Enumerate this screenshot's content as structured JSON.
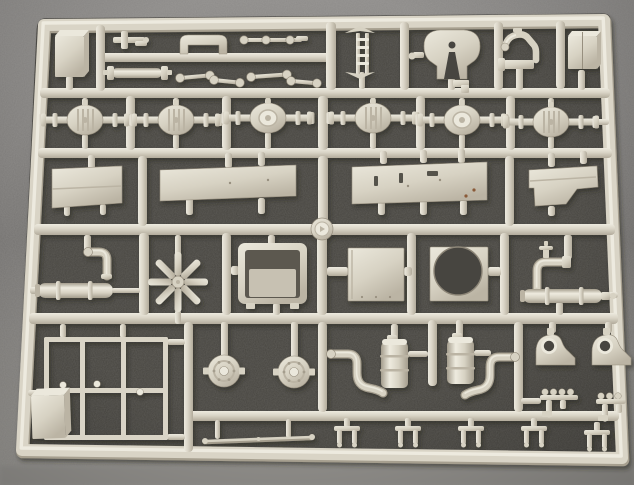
{
  "image": {
    "width": 634,
    "height": 485,
    "alt": "Photo of a light-beige plastic model kit sprue (runner frame) holding truck parts on a dark gray speckled surface"
  },
  "palette": {
    "bgTop": "#8d8b89",
    "bgMid": "#757371",
    "bgBottom": "#93918d",
    "window": "#46443f",
    "barHi": "#edeadf",
    "barMid": "#d9d4c6",
    "barLo": "#b2ab9b",
    "barShadow": "#a69f8f",
    "partHi": "#ebe8dc",
    "partMid": "#d7d2c3",
    "partLo": "#bbb4a4",
    "cylEdge": "#a49d8d",
    "cylLight": "#eeebdf",
    "line": "#978f7f",
    "dark": "#55524b",
    "rust": "#8a5a38"
  },
  "sprue": {
    "frame": {
      "path": "M 44 25 L 604 20 L 622 458 L 22 450 Z",
      "width": 13
    },
    "silhouette": "M 45 18.3 L 603 13.5 Q 610.5 13.4 610.8 21 L 628.3 451 Q 628.6 464.4 621 464.2 L 29 456.8 Q 15.6 456.6 16.6 445 L 36.6 29 Q 37.8 18.4 45 18.3 Z",
    "hbars": [
      [
        96,
        53,
        238,
        9
      ],
      [
        40,
        88,
        570,
        10
      ],
      [
        38,
        148,
        574,
        10
      ],
      [
        34,
        224,
        581,
        11
      ],
      [
        29,
        313,
        589,
        11
      ],
      [
        187,
        411,
        432,
        10
      ]
    ],
    "vbars": [
      [
        96,
        25,
        9,
        66
      ],
      [
        326,
        22,
        10,
        68
      ],
      [
        400,
        22,
        9,
        68
      ],
      [
        494,
        22,
        9,
        68
      ],
      [
        556,
        21,
        9,
        68
      ],
      [
        126,
        96,
        9,
        54
      ],
      [
        222,
        96,
        9,
        54
      ],
      [
        318,
        96,
        10,
        54
      ],
      [
        416,
        96,
        9,
        54
      ],
      [
        506,
        96,
        9,
        54
      ],
      [
        138,
        156,
        9,
        70
      ],
      [
        318,
        156,
        10,
        70
      ],
      [
        505,
        156,
        9,
        70
      ],
      [
        139,
        233,
        10,
        82
      ],
      [
        222,
        233,
        9,
        82
      ],
      [
        317,
        233,
        10,
        82
      ],
      [
        407,
        233,
        9,
        82
      ],
      [
        500,
        233,
        9,
        82
      ],
      [
        184,
        322,
        9,
        130
      ],
      [
        318,
        322,
        9,
        90
      ],
      [
        428,
        320,
        9,
        66
      ],
      [
        514,
        322,
        9,
        90
      ]
    ],
    "stubs": [
      [
        66,
        76,
        7,
        14
      ],
      [
        448,
        78,
        7,
        12
      ],
      [
        516,
        66,
        7,
        24
      ],
      [
        359,
        72,
        6,
        17
      ],
      [
        578,
        70,
        7,
        20
      ],
      [
        82,
        98,
        6,
        9
      ],
      [
        82,
        134,
        6,
        15
      ],
      [
        173,
        98,
        6,
        9
      ],
      [
        173,
        134,
        6,
        15
      ],
      [
        265,
        98,
        6,
        7
      ],
      [
        265,
        132,
        6,
        17
      ],
      [
        370,
        98,
        6,
        7
      ],
      [
        370,
        132,
        6,
        17
      ],
      [
        459,
        98,
        6,
        9
      ],
      [
        459,
        134,
        6,
        15
      ],
      [
        548,
        98,
        6,
        11
      ],
      [
        548,
        136,
        6,
        13
      ],
      [
        595,
        119,
        14,
        6
      ],
      [
        88,
        155,
        7,
        14
      ],
      [
        64,
        205,
        6,
        11
      ],
      [
        100,
        204,
        6,
        11
      ],
      [
        225,
        153,
        7,
        15
      ],
      [
        258,
        152,
        7,
        14
      ],
      [
        186,
        198,
        7,
        17
      ],
      [
        258,
        198,
        7,
        16
      ],
      [
        380,
        151,
        7,
        13
      ],
      [
        420,
        150,
        7,
        13
      ],
      [
        458,
        149,
        7,
        14
      ],
      [
        378,
        200,
        7,
        15
      ],
      [
        420,
        200,
        7,
        15
      ],
      [
        460,
        200,
        7,
        15
      ],
      [
        548,
        153,
        7,
        14
      ],
      [
        580,
        151,
        7,
        13
      ],
      [
        548,
        206,
        7,
        10
      ],
      [
        84,
        235,
        7,
        18
      ],
      [
        30,
        287,
        9,
        7
      ],
      [
        175,
        235,
        6,
        20
      ],
      [
        175,
        310,
        6,
        14
      ],
      [
        268,
        235,
        7,
        10
      ],
      [
        273,
        303,
        7,
        12
      ],
      [
        231,
        266,
        8,
        9
      ],
      [
        327,
        267,
        21,
        9
      ],
      [
        404,
        267,
        8,
        9
      ],
      [
        488,
        267,
        13,
        9
      ],
      [
        564,
        235,
        8,
        24
      ],
      [
        556,
        302,
        7,
        13
      ],
      [
        608,
        292,
        10,
        6
      ],
      [
        60,
        324,
        6,
        14
      ],
      [
        120,
        324,
        6,
        14
      ],
      [
        28,
        390,
        17,
        6
      ],
      [
        167,
        339,
        18,
        6
      ],
      [
        167,
        434,
        18,
        6
      ],
      [
        221,
        322,
        7,
        35
      ],
      [
        291,
        322,
        7,
        36
      ],
      [
        391,
        324,
        7,
        19
      ],
      [
        456,
        320,
        7,
        21
      ],
      [
        408,
        351,
        20,
        6
      ],
      [
        474,
        350,
        17,
        6
      ],
      [
        215,
        420,
        5,
        19
      ],
      [
        286,
        419,
        5,
        19
      ],
      [
        549,
        322,
        7,
        11
      ],
      [
        605,
        322,
        7,
        11
      ],
      [
        521,
        398,
        20,
        6
      ]
    ],
    "parts": [
      {
        "type": "isoBox",
        "name": "tank-box-top-left",
        "x": 55,
        "y": 36,
        "w": 29,
        "h": 41,
        "dx": 5,
        "dy": 6
      },
      {
        "type": "smallBracket",
        "name": "bracket-small-top",
        "x": 113,
        "y": 31
      },
      {
        "type": "bridge",
        "name": "cab-mount-bridge",
        "x": 180,
        "y": 35
      },
      {
        "type": "linkChain",
        "name": "linkage-row-top",
        "x": 240,
        "y": 40
      },
      {
        "type": "tieRod",
        "name": "tie-rod-cylinder",
        "x": 107,
        "y": 66
      },
      {
        "type": "dogbone",
        "name": "link-rod-1",
        "x": 180,
        "y": 78,
        "len": 30,
        "ang": -5
      },
      {
        "type": "dogbone",
        "name": "link-rod-2",
        "x": 214,
        "y": 80,
        "len": 26,
        "ang": 6
      },
      {
        "type": "dogbone",
        "name": "link-rod-3",
        "x": 251,
        "y": 77,
        "len": 36,
        "ang": -4
      },
      {
        "type": "dogbone",
        "name": "link-rod-4",
        "x": 291,
        "y": 81,
        "len": 26,
        "ang": 5
      },
      {
        "type": "ladder",
        "name": "ladder-frame-part",
        "x": 345,
        "y": 26
      },
      {
        "type": "fifthWheel",
        "name": "fifth-wheel-coupling",
        "x": 424,
        "y": 30
      },
      {
        "type": "faucet",
        "name": "gooseneck-pipe",
        "x": 498,
        "y": 30
      },
      {
        "type": "isoBox",
        "name": "tank-box-top-right",
        "x": 568,
        "y": 36,
        "w": 29,
        "h": 33,
        "dx": 4,
        "dy": 5,
        "seam": true
      },
      {
        "type": "axle",
        "name": "front-axle-1",
        "cx": 85,
        "cy": 120,
        "half": 42,
        "ribbed": true
      },
      {
        "type": "axle",
        "name": "front-axle-2",
        "cx": 176,
        "cy": 120,
        "half": 42,
        "ribbed": true
      },
      {
        "type": "axle",
        "name": "axle-3",
        "cx": 268,
        "cy": 118,
        "half": 42,
        "ribbed": false
      },
      {
        "type": "axle",
        "name": "axle-4",
        "cx": 373,
        "cy": 118,
        "half": 42,
        "ribbed": true
      },
      {
        "type": "axle",
        "name": "axle-5",
        "cx": 462,
        "cy": 120,
        "half": 42,
        "ribbed": false
      },
      {
        "type": "axle",
        "name": "rear-axle-6",
        "cx": 551,
        "cy": 122,
        "half": 46,
        "ribbed": true
      },
      {
        "type": "panel",
        "name": "panel-small-left",
        "pts": [
          [
            52,
            169
          ],
          [
            122,
            166
          ],
          [
            122,
            203
          ],
          [
            52,
            208
          ]
        ],
        "crease": [
          [
            52,
            189
          ],
          [
            122,
            186
          ]
        ]
      },
      {
        "type": "panel",
        "name": "panel-long-a",
        "pts": [
          [
            160,
            170
          ],
          [
            296,
            165
          ],
          [
            296,
            196
          ],
          [
            160,
            201
          ]
        ],
        "dots": [
          [
            230,
            183
          ],
          [
            268,
            180
          ]
        ]
      },
      {
        "type": "panel",
        "name": "panel-long-b",
        "pts": [
          [
            352,
            167
          ],
          [
            487,
            162
          ],
          [
            487,
            200
          ],
          [
            352,
            204
          ]
        ],
        "slots": [
          [
            374,
            176,
            4,
            10
          ],
          [
            399,
            173,
            4,
            10
          ],
          [
            427,
            171,
            11,
            5
          ]
        ],
        "dots": [
          [
            440,
            180
          ],
          [
            408,
            186
          ]
        ],
        "rust": [
          [
            474,
            190
          ],
          [
            466,
            196
          ]
        ]
      },
      {
        "type": "panel",
        "name": "panel-notched",
        "pts": [
          [
            529,
            170
          ],
          [
            597,
            166
          ],
          [
            598,
            187
          ],
          [
            577,
            189
          ],
          [
            566,
            204
          ],
          [
            535,
            206
          ],
          [
            534,
            188
          ],
          [
            529,
            188
          ]
        ],
        "crease": [
          [
            530,
            181
          ],
          [
            596,
            177
          ]
        ]
      },
      {
        "type": "elbow",
        "name": "elbow-pipe-left",
        "path": "M 88 252 L 99 252 Q 107 252 107 260 L 107 276",
        "flange": [
          88,
          252
        ],
        "cap": [
          101,
          274,
          11,
          5
        ]
      },
      {
        "type": "mufflerH",
        "name": "muffler-left",
        "x": 38,
        "y": 283,
        "w": 75,
        "h": 15,
        "collars": [
          56,
          88
        ],
        "tail": [
          112,
          288,
          28,
          5
        ]
      },
      {
        "type": "fan",
        "name": "fan-star",
        "cx": 178,
        "cy": 282,
        "r": 30
      },
      {
        "type": "openBox",
        "name": "open-tray-box",
        "x": 238,
        "y": 243,
        "w": 69,
        "h": 61
      },
      {
        "type": "plate",
        "name": "flat-plate",
        "x": 348,
        "y": 248,
        "w": 56,
        "h": 53
      },
      {
        "type": "plateHole",
        "name": "plate-round-hole",
        "x": 430,
        "y": 247,
        "w": 58,
        "h": 54,
        "hole": [
          458,
          271,
          24
        ]
      },
      {
        "type": "valveElbow",
        "name": "valve-elbow-right",
        "path": "M 566 262 L 546 262 Q 537 262 537 271 L 537 289",
        "flange": [
          562,
          256,
          9,
          12
        ],
        "valve": [
          543,
          243
        ]
      },
      {
        "type": "mufflerH",
        "name": "muffler-right",
        "x": 523,
        "y": 289,
        "w": 79,
        "h": 14,
        "collars": [
          545,
          579
        ],
        "nozzle": [
          601,
          292
        ]
      },
      {
        "type": "grid",
        "name": "rack-grid",
        "x": 44,
        "y": 337,
        "w": 124,
        "h": 103,
        "cols": [
          80,
          121
        ],
        "midY": 388,
        "knobs": [
          [
            63,
            385
          ],
          [
            97,
            384
          ],
          [
            140,
            392
          ]
        ]
      },
      {
        "type": "isoBox",
        "name": "battery-box-bottom-left",
        "x": 31,
        "y": 396,
        "w": 33,
        "h": 43,
        "dx": 6,
        "dy": 7,
        "rot": -2
      },
      {
        "type": "hubCap",
        "name": "hub-cover-1",
        "cx": 224,
        "cy": 371
      },
      {
        "type": "hubCap",
        "name": "hub-cover-2",
        "cx": 294,
        "cy": 372
      },
      {
        "type": "thinRod",
        "name": "torque-rod",
        "x1": 205,
        "y1": 441,
        "x2": 312,
        "y2": 437
      },
      {
        "type": "tankPipe",
        "name": "air-tank-1",
        "tank": [
          381,
          342,
          27,
          46
        ],
        "pipe": "M 331 354 L 348 354 Q 357 354 357 364 L 357 373 Q 357 386 369 388 Q 379 390 383 393",
        "flange": [
          331,
          354
        ],
        "filler": [
          387,
          335
        ]
      },
      {
        "type": "tankPipe",
        "name": "air-tank-2",
        "tank": [
          447,
          340,
          27,
          44
        ],
        "pipe": "M 515 357 L 499 357 Q 490 357 490 367 L 490 375 Q 490 388 478 390 Q 469 392 465 395",
        "flange": [
          515,
          357
        ],
        "filler": [
          452,
          333
        ]
      },
      {
        "type": "bracketHole",
        "name": "spring-hanger-1",
        "x": 536,
        "y": 332
      },
      {
        "type": "bracketHole",
        "name": "spring-hanger-2",
        "x": 592,
        "y": 332
      },
      {
        "type": "manifold",
        "name": "manifold-part-1",
        "x": 540,
        "y": 390,
        "balls": 4
      },
      {
        "type": "manifold",
        "name": "manifold-part-2",
        "x": 596,
        "y": 394,
        "balls": 3
      },
      {
        "type": "clip",
        "name": "clip-1",
        "x": 334,
        "y": 426
      },
      {
        "type": "clip",
        "name": "clip-2",
        "x": 395,
        "y": 426
      },
      {
        "type": "clip",
        "name": "clip-3",
        "x": 458,
        "y": 426
      },
      {
        "type": "clip",
        "name": "clip-4",
        "x": 521,
        "y": 426
      },
      {
        "type": "clip",
        "name": "clip-5",
        "x": 584,
        "y": 430
      },
      {
        "type": "centerHub",
        "name": "sprue-center-gate",
        "cx": 322,
        "cy": 229
      }
    ]
  }
}
